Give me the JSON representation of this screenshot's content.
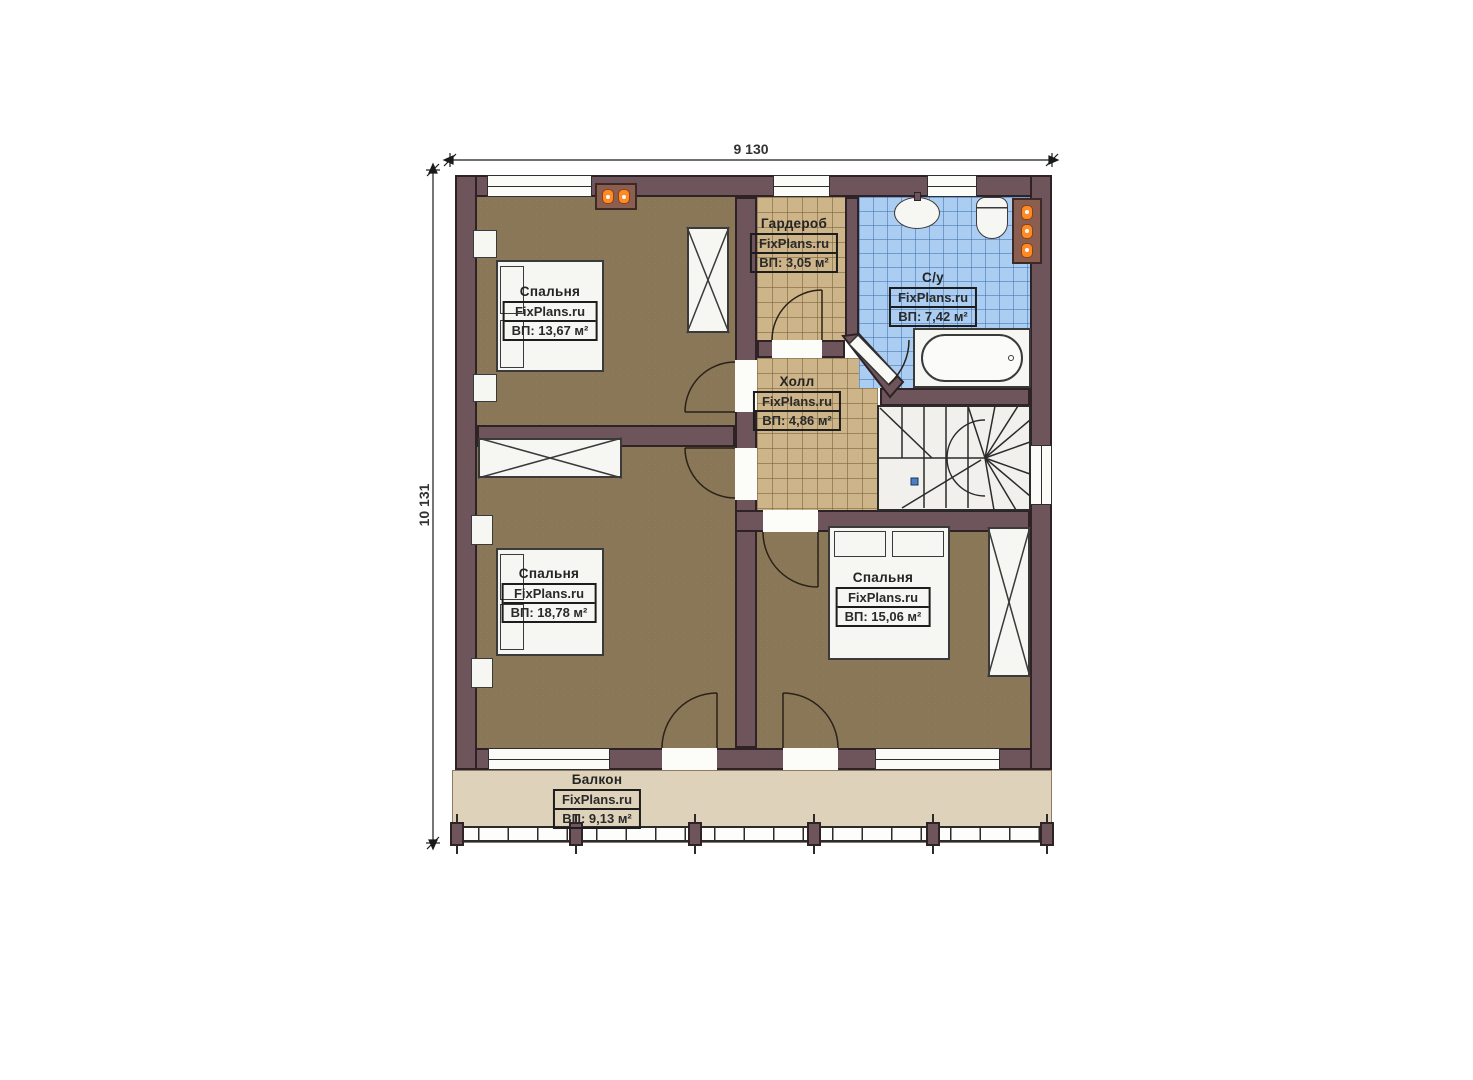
{
  "plan": {
    "brand": "FixPlans.ru",
    "dimensions": {
      "width": "9 130",
      "height": "10 131"
    },
    "rooms": [
      {
        "id": "bedroom-1",
        "name": "Спальня",
        "brand": "FixPlans.ru",
        "area": "ВП: 13,67 м²"
      },
      {
        "id": "wardrobe",
        "name": "Гардероб",
        "brand": "FixPlans.ru",
        "area": "ВП: 3,05 м²"
      },
      {
        "id": "bathroom",
        "name": "С/у",
        "brand": "FixPlans.ru",
        "area": "ВП: 7,42 м²"
      },
      {
        "id": "hall",
        "name": "Холл",
        "brand": "FixPlans.ru",
        "area": "ВП: 4,86 м²"
      },
      {
        "id": "bedroom-2",
        "name": "Спальня",
        "brand": "FixPlans.ru",
        "area": "ВП: 18,78 м²"
      },
      {
        "id": "bedroom-3",
        "name": "Спальня",
        "brand": "FixPlans.ru",
        "area": "ВП: 15,06 м²"
      },
      {
        "id": "balcony",
        "name": "Балкон",
        "brand": "FixPlans.ru",
        "area": "ВП: 9,13 м²"
      }
    ],
    "colors": {
      "wall": "#6d555b",
      "wall_outline": "#2e2227",
      "bedroom_floor": "#897757",
      "hall_tile": "#cdb489",
      "bath_tile": "#abcdf1",
      "balcony_floor": "#ded2bb",
      "radiator": "#ff8a25"
    }
  }
}
